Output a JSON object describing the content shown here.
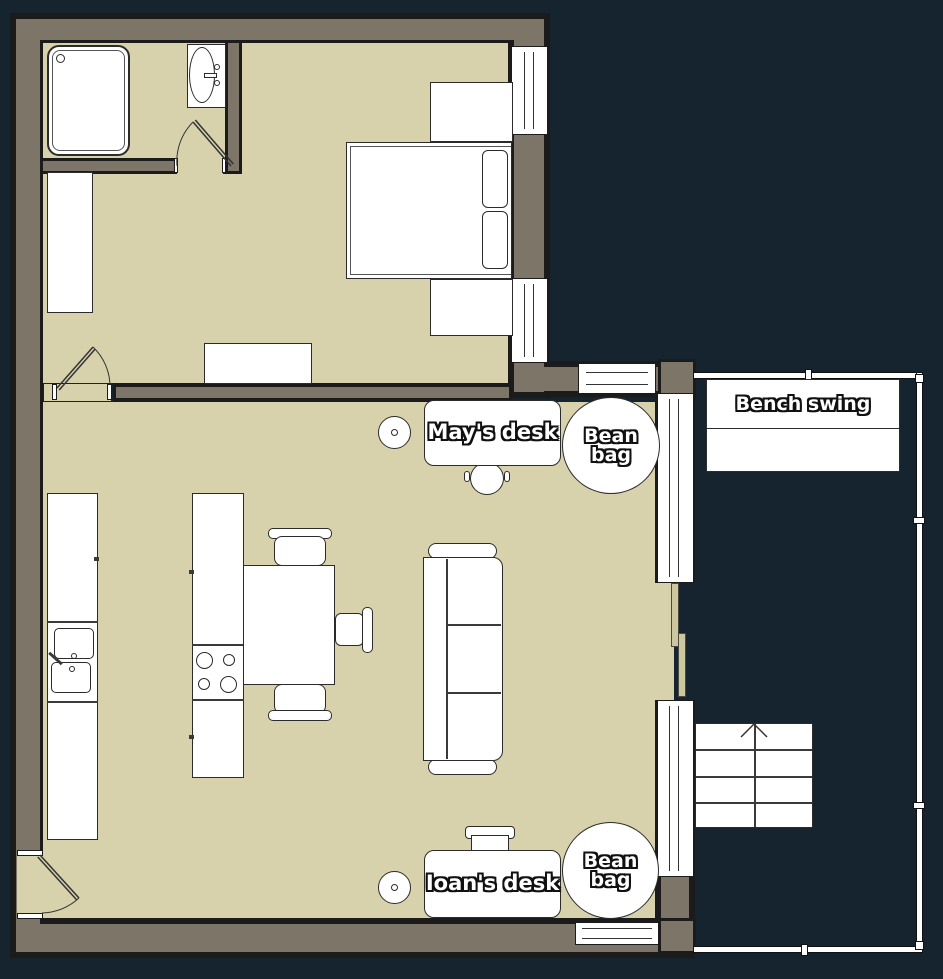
{
  "labels": {
    "mays_desk": "May's desk",
    "ioans_desk": "Ioan's desk",
    "bean_bag_top": "Bean bag",
    "bean_bag_bottom": "Bean bag",
    "bench_swing": "Bench swing"
  },
  "colors": {
    "background": "#15242e",
    "floor": "#d7d2ac",
    "wall_fill": "#7d7568",
    "wall_outline": "#1b1b1b",
    "furniture_fill": "#ffffff",
    "furniture_outline": "#2b2b2b",
    "sliding_panel": "#cdc7a0",
    "label_text": "#ffffff",
    "label_outline": "#111111"
  }
}
